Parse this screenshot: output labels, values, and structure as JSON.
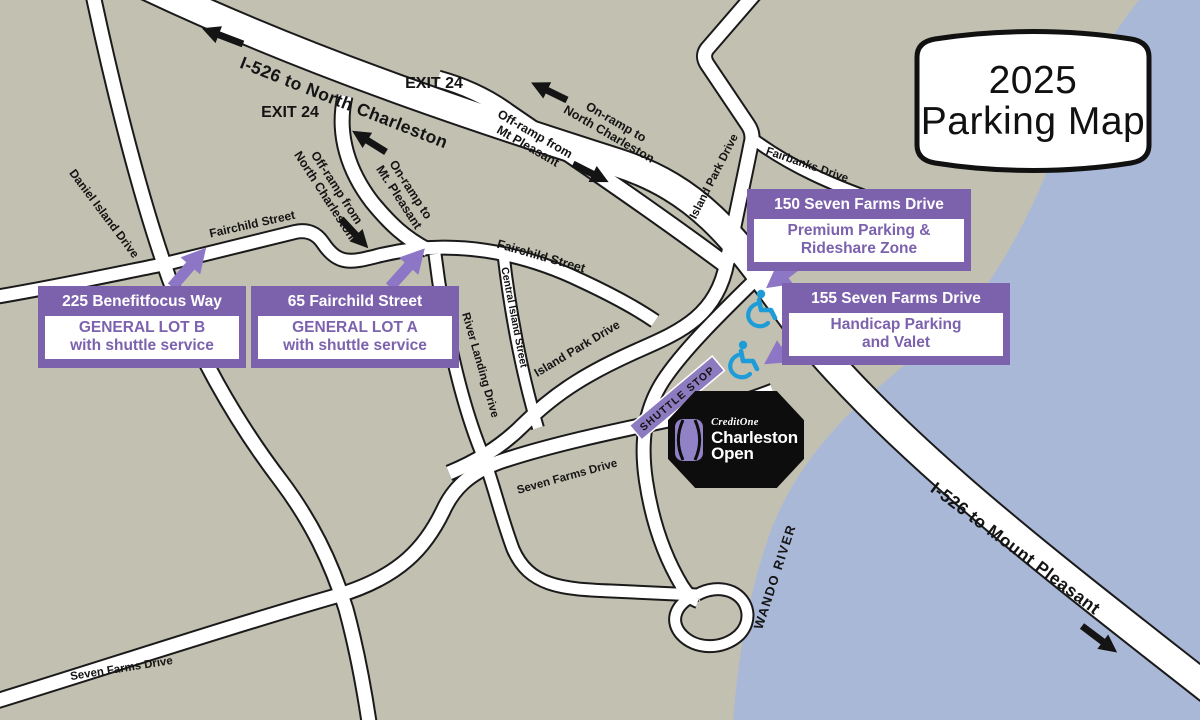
{
  "title": {
    "year": "2025",
    "label": "Parking Map"
  },
  "colors": {
    "land": "#c2c0b1",
    "water": "#aab8d8",
    "road_fill": "#ffffff",
    "road_casing": "#1a1a1a",
    "callout_purple": "#7c62ad",
    "arrow_purple": "#8d76c6",
    "handicap_blue": "#1e9cd7",
    "venue_black": "#0d0d0d"
  },
  "highway": {
    "north_label": "I-526 to North Charleston",
    "south_label": "I-526 to Mount Pleasant"
  },
  "exits": {
    "left": "EXIT 24",
    "right": "EXIT 24"
  },
  "ramps": {
    "off_left": {
      "line1": "Off-ramp from",
      "line2": "North Charleston"
    },
    "on_left": {
      "line1": "On-ramp to",
      "line2": "Mt. Pleasant"
    },
    "off_right": {
      "line1": "Off-ramp from",
      "line2": "Mt Pleasant"
    },
    "on_right": {
      "line1": "On-ramp to",
      "line2": "North Charleston"
    }
  },
  "streets": {
    "daniel_island": "Daniel Island Drive",
    "fairchild_1": "Fairchild Street",
    "fairchild_2": "Fairchild Street",
    "central_island": "Central Island Street",
    "river_landing": "River Landing Drive",
    "island_park_1": "Island Park Drive",
    "island_park_2": "Island Park Drive",
    "fairbanks": "Fairbanks Drive",
    "seven_farms_mid": "Seven Farms Drive",
    "seven_farms_bottom": "Seven Farms Drive"
  },
  "river": "WANDO RIVER",
  "shuttle_stop": "SHUTTLE STOP",
  "callouts": [
    {
      "address": "225 Benefitfocus Way",
      "line1": "GENERAL LOT B",
      "line2": "with shuttle service"
    },
    {
      "address": "65 Fairchild Street",
      "line1": "GENERAL LOT A",
      "line2": "with shuttle service"
    },
    {
      "address": "150 Seven Farms Drive",
      "line1": "Premium Parking &",
      "line2": "Rideshare Zone"
    },
    {
      "address": "155 Seven Farms Drive",
      "line1": "Handicap Parking",
      "line2": "and Valet"
    }
  ],
  "venue": {
    "brand": "CreditOne",
    "name_line1": "Charleston",
    "name_line2": "Open"
  }
}
